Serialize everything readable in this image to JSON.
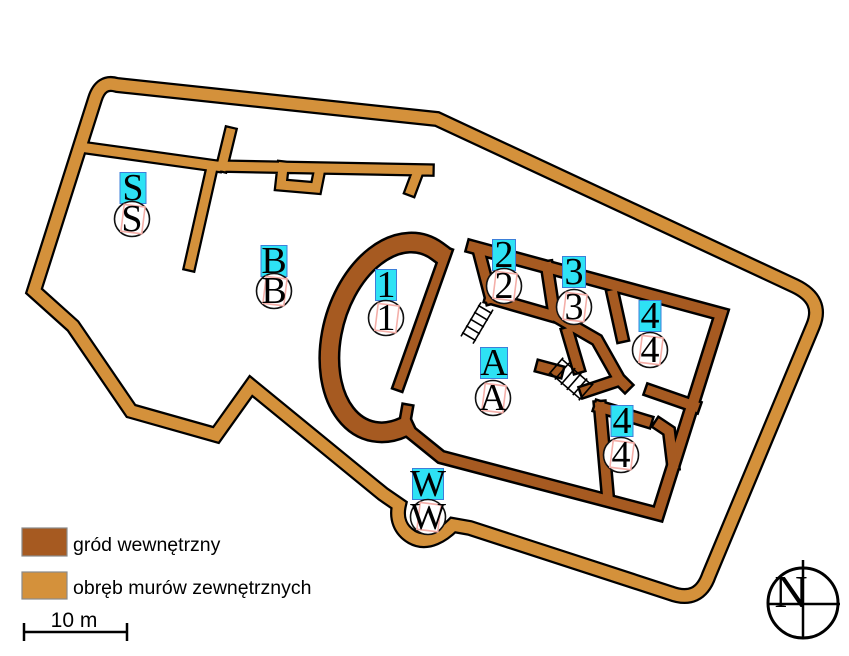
{
  "colors": {
    "outer_wall": "#D4913B",
    "inner_wall": "#A65A21",
    "wall_outline": "#000000",
    "label_box_fill": "#2EE2F4",
    "label_box_border": "#3D7FD9",
    "ghost_box": "#F4AFA9",
    "swatch_border": "#8A8A8A",
    "background": "#FFFFFF"
  },
  "legend": {
    "items": [
      {
        "label": "gród wewnętrzny",
        "color": "#A65A21"
      },
      {
        "label": "obręb murów zewnętrznych",
        "color": "#D4913B"
      }
    ]
  },
  "scale_bar": {
    "label": "10 m"
  },
  "compass": {
    "label": "N"
  },
  "site_labels": [
    {
      "id": "S",
      "text": "S",
      "box": [
        133,
        188
      ],
      "box_w": 26,
      "circle": [
        132,
        219
      ]
    },
    {
      "id": "B",
      "text": "B",
      "box": [
        274,
        261
      ],
      "box_w": 26,
      "circle": [
        274,
        291
      ]
    },
    {
      "id": "1",
      "text": "1",
      "box": [
        386,
        285
      ],
      "box_w": 21,
      "circle": [
        386,
        318
      ]
    },
    {
      "id": "2",
      "text": "2",
      "box": [
        504,
        255
      ],
      "box_w": 23,
      "circle": [
        504,
        286
      ]
    },
    {
      "id": "3",
      "text": "3",
      "box": [
        574,
        272
      ],
      "box_w": 23,
      "circle": [
        574,
        307
      ]
    },
    {
      "id": "4-upper",
      "text": "4",
      "box": [
        650,
        316
      ],
      "box_w": 22,
      "circle": [
        650,
        350
      ]
    },
    {
      "id": "4-lower",
      "text": "4",
      "box": [
        622,
        421
      ],
      "box_w": 22,
      "circle": [
        621,
        455
      ]
    },
    {
      "id": "A",
      "text": "A",
      "box": [
        494,
        363
      ],
      "box_w": 27,
      "circle": [
        493,
        398
      ]
    },
    {
      "id": "W",
      "text": "W",
      "box": [
        428,
        484
      ],
      "box_w": 31,
      "circle": [
        428,
        517
      ]
    }
  ]
}
